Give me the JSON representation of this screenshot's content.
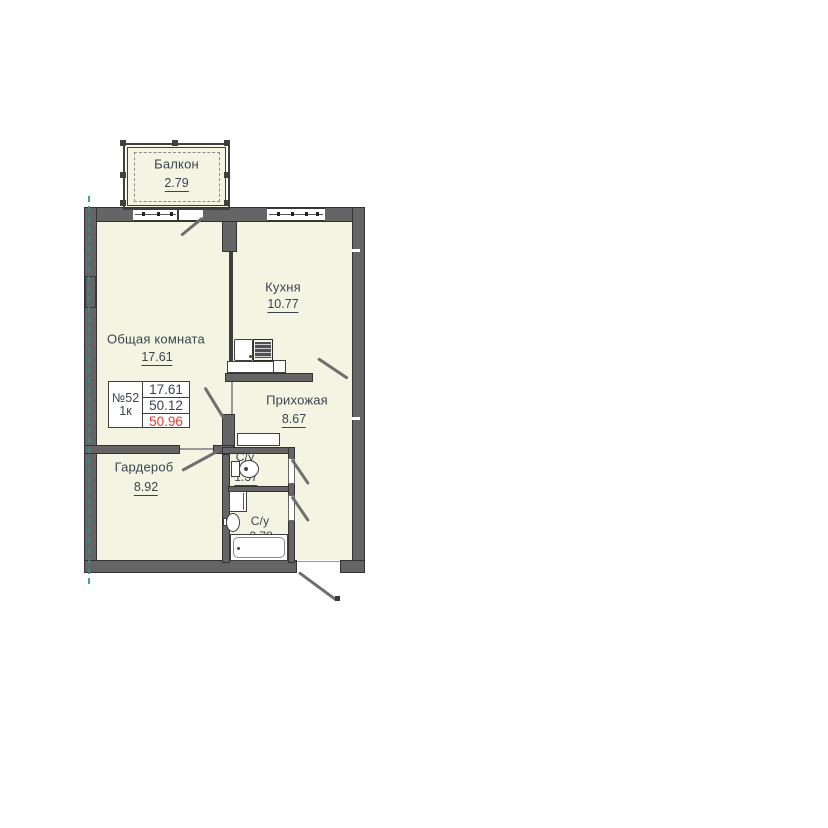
{
  "plan": {
    "unit_card": {
      "number": "№52",
      "type": "1к",
      "living_area": "17.61",
      "area_no_balcony": "50.12",
      "total_area": "50.96"
    },
    "rooms": {
      "balcony": {
        "name": "Балкон",
        "area": "2.79"
      },
      "kitchen": {
        "name": "Кухня",
        "area": "10.77"
      },
      "living": {
        "name": "Общая комната",
        "area": "17.61"
      },
      "hallway": {
        "name": "Прихожая",
        "area": "8.67"
      },
      "wardrobe": {
        "name": "Гардероб",
        "area": "8.92"
      },
      "bath1": {
        "name": "С/у",
        "area": "1.37"
      },
      "bath2": {
        "name": "С/у",
        "area": "2.78"
      }
    },
    "fixtures": [
      "kitchen-sink-icon",
      "stove-icon",
      "toilet-icon",
      "washbasin-icon",
      "bathtub-icon",
      "washing-machine-icon"
    ],
    "colors": {
      "room_fill": "#f3f5e2",
      "wall": "#656565",
      "wall_outline": "#333333",
      "text": "#3b4351",
      "area_red": "#e23b2b",
      "axis": "#2f8f96",
      "door_swing": "#6f6f6f"
    }
  }
}
